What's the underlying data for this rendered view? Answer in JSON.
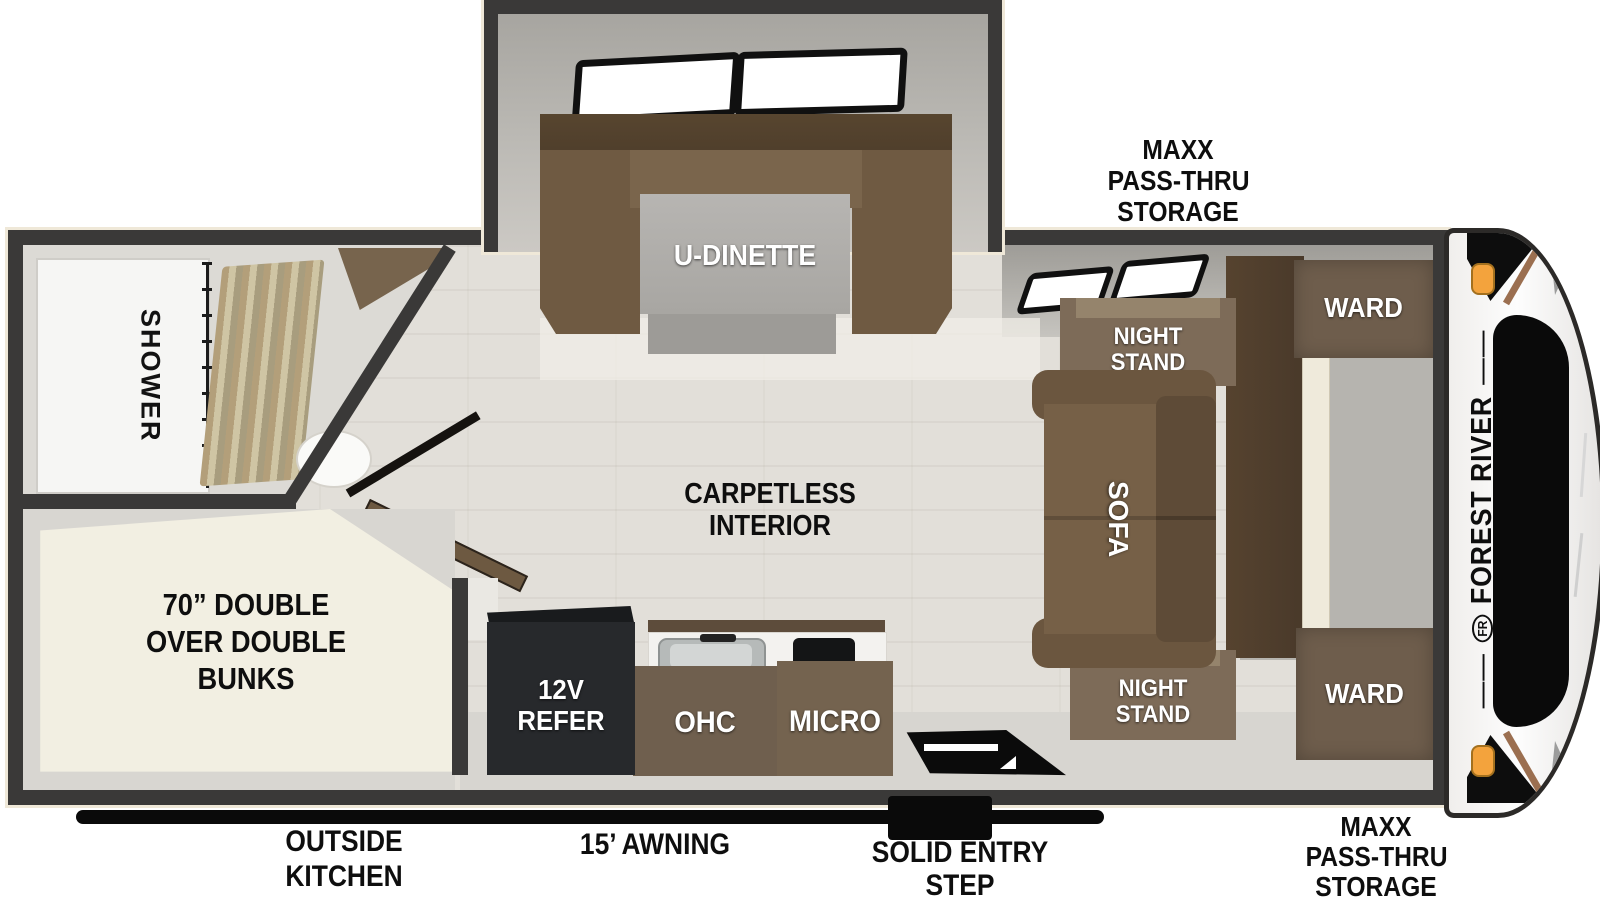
{
  "floorplan": {
    "brand": "FOREST RIVER",
    "brand_monogram": "FR",
    "labels": {
      "storage_front_top": {
        "line1": "MAXX",
        "line2": "PASS-THRU",
        "line3": "STORAGE"
      },
      "storage_front_bottom": {
        "line1": "MAXX",
        "line2": "PASS-THRU",
        "line3": "STORAGE"
      },
      "u_dinette": "U-DINETTE",
      "shower": "SHOWER",
      "night_stand_top": {
        "line1": "NIGHT",
        "line2": "STAND"
      },
      "night_stand_bottom": {
        "line1": "NIGHT",
        "line2": "STAND"
      },
      "ward_top": "WARD",
      "ward_bottom": "WARD",
      "sofa": "SOFA",
      "carpetless": {
        "line1": "CARPETLESS",
        "line2": "INTERIOR"
      },
      "bunks": {
        "line1": "70” DOUBLE",
        "line2": "OVER DOUBLE",
        "line3": "BUNKS"
      },
      "refer": {
        "line1": "12V",
        "line2": "REFER"
      },
      "ohc": "OHC",
      "micro": "MICRO",
      "outside_kitchen": {
        "line1": "OUTSIDE",
        "line2": "KITCHEN"
      },
      "awning": "15’ AWNING",
      "entry_step": {
        "line1": "SOLID ENTRY",
        "line2": "STEP"
      }
    },
    "colors": {
      "wall": "#3a3938",
      "wall_trim": "#efe8d8",
      "floor_wood": "#e2dfd9",
      "slide_gray": "#bcbab5",
      "furniture_brown": "#6f5f4e",
      "sofa_brown": "#6b563f",
      "dark_brown": "#4a3a2b",
      "mattress_cream": "#f2efe2",
      "refer_black": "#27292c",
      "accent_black": "#0a0a0a",
      "marker_orange": "#f3a33d",
      "cap_stripe_brown": "#9b6f50"
    }
  }
}
